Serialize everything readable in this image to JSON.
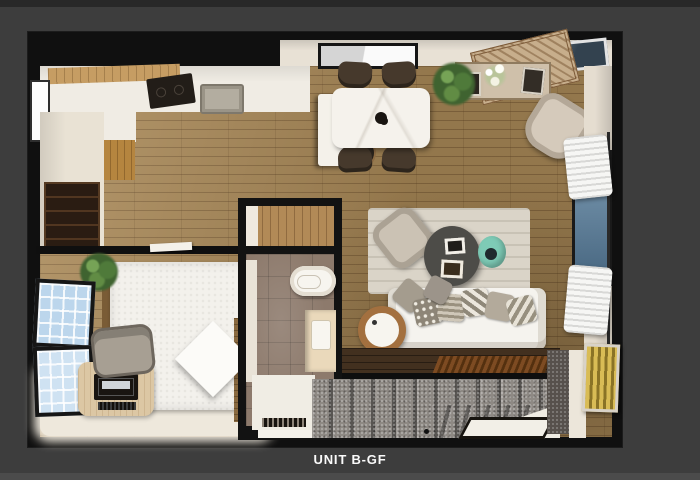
{
  "caption": {
    "title": "UNIT B-GF"
  },
  "colors": {
    "background": "#3d3d3d",
    "backgroundTopStrip": "#282828",
    "backgroundBottomStrip": "#4b4b4b",
    "wall": "#101010",
    "wood": "#ab8a58",
    "counter": "#f0ece4",
    "cabinetWood": "#b5853f",
    "cooktop": "#221d18",
    "marbleTable": "#f5f2ec",
    "chair": "#46392c",
    "rugWall": "#c7ae8c",
    "armchair": "#d5cabb",
    "wallBeige": "#e5ddd0",
    "glassBlue": "#7d9cb4",
    "curtain": "#f6f6f4",
    "livingRug": "#dad4c8",
    "coffeeTable": "#4d4c48",
    "teal": "#7ecbb6",
    "sofa": "#f5f3ee",
    "lampCopper": "#a3703f",
    "darkFloor": "#42301f",
    "matBrown": "#7d4b22",
    "stairs": "#8e8984",
    "landing": "#efece3",
    "artYellow": "#c9a93e",
    "tile": "#8d7a6c",
    "porcelain": "#f7f5ef",
    "vanity": "#ead9bb",
    "bed": "#f3f1ec",
    "bedWood": "#8a6a40",
    "desk": "#dcc7a4",
    "monitor": "#191511",
    "windowGlass": "#bcd6ec",
    "hallFloor": "#e9e2d4",
    "dresser": "#2a1c12",
    "skylightGlass": "#33424f",
    "caption": "#fafafa"
  }
}
